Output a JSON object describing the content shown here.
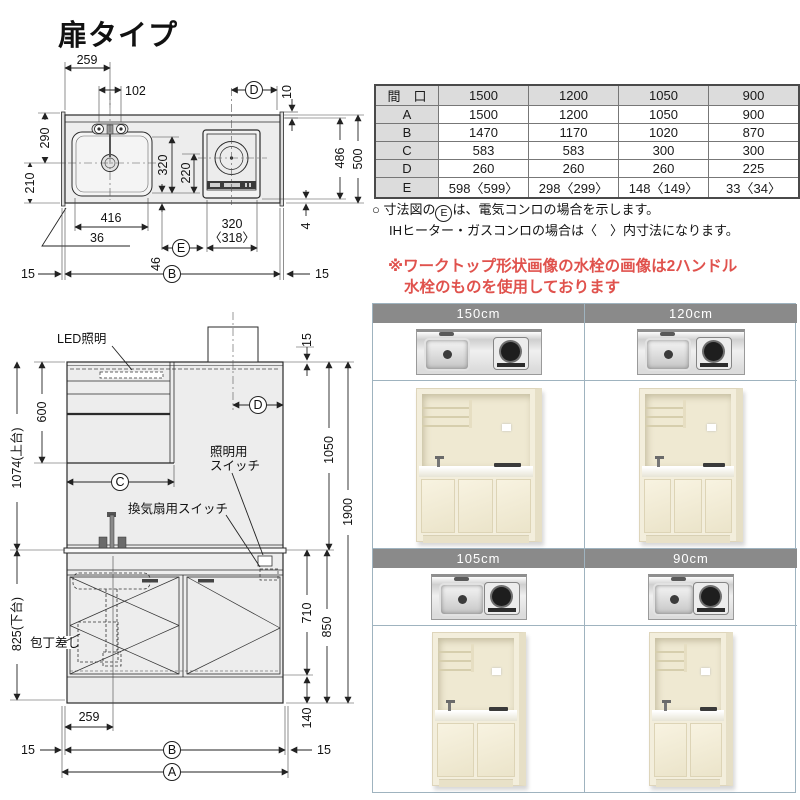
{
  "page": {
    "title": "扉タイプ"
  },
  "spec_table": {
    "header": [
      "間　口",
      "1500",
      "1200",
      "1050",
      "900"
    ],
    "rows": [
      [
        "A",
        "1500",
        "1200",
        "1050",
        "900"
      ],
      [
        "B",
        "1470",
        "1170",
        "1020",
        "870"
      ],
      [
        "C",
        "583",
        "583",
        "300",
        "300"
      ],
      [
        "D",
        "260",
        "260",
        "260",
        "225"
      ],
      [
        "E",
        "598〈599〉",
        "298〈299〉",
        "148〈149〉",
        "33〈34〉"
      ]
    ]
  },
  "notes": {
    "line1_prefix": "○ 寸法図の",
    "line1_circle": "E",
    "line1_suffix": "は、電気コンロの場合を示します。",
    "line2": "IHヒーター・ガスコンロの場合は〈　〉内寸法になります。"
  },
  "warning": {
    "line1": "※ワークトップ形状画像の水栓の画像は2ハンドル",
    "line2": "水栓のものを使用しております"
  },
  "gallery": {
    "cells": [
      {
        "label": "150cm"
      },
      {
        "label": "120cm"
      },
      {
        "label": "105cm"
      },
      {
        "label": "90cm"
      }
    ]
  },
  "plan": {
    "dims": {
      "w259": "259",
      "w102": "102",
      "c_d": "D",
      "g10": "10",
      "h290": "290",
      "h210": "210",
      "h320": "320",
      "h220": "220",
      "h486": "486",
      "h500": "500",
      "g4": "4",
      "w416": "416",
      "g36": "36",
      "g46": "46",
      "c_e": "E",
      "w320": "320",
      "w318": "〈318〉",
      "m15l": "15",
      "c_b": "B",
      "m15r": "15"
    }
  },
  "elevation": {
    "labels": {
      "led": "LED照明",
      "sw_light1": "照明用",
      "sw_light2": "スイッチ",
      "sw_fan": "換気扇用スイッチ",
      "knife": "包丁差し"
    },
    "dims": {
      "g15": "15",
      "h600": "600",
      "h1074": "1074(上台)",
      "c_c": "C",
      "c_d": "D",
      "h1050": "1050",
      "h1900": "1900",
      "h825": "825(下台)",
      "h710": "710",
      "h850": "850",
      "h140": "140",
      "w259": "259",
      "m15l": "15",
      "c_b": "B",
      "c_a": "A",
      "m15r": "15"
    }
  },
  "colors": {
    "warning_red": "#e0524d",
    "gallery_header_gray": "#8a8a8a",
    "grid_border": "#9fb3bf",
    "cabinet_cream": "#f3eedc"
  }
}
